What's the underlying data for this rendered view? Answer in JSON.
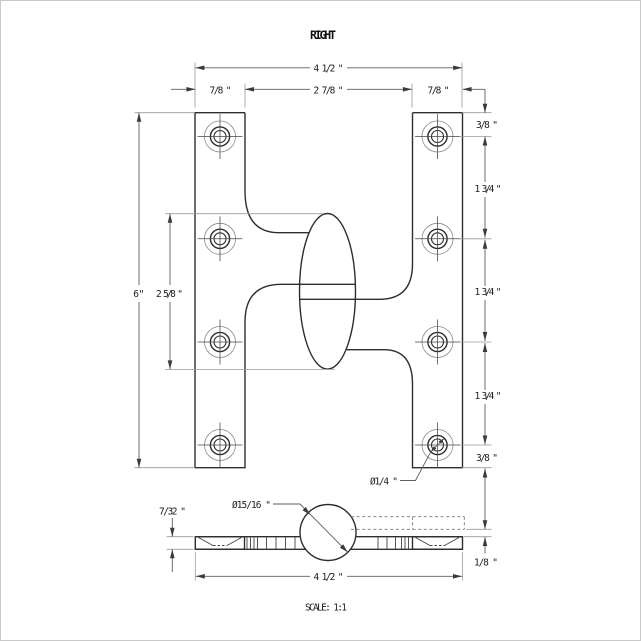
{
  "title": "RIGHT",
  "scale_label": "SCALE: 1:1",
  "front_view": {
    "overall_width": "4 1/2 \"",
    "left_leaf_width": "7/8 \"",
    "center_span": "2 7/8 \"",
    "right_leaf_width": "7/8 \"",
    "top_margin": "3/8 \"",
    "hole_pitch": [
      "1 3/4 \"",
      "1 3/4 \"",
      "1 3/4 \""
    ],
    "bottom_margin": "3/8 \"",
    "overall_height": "6\"",
    "knuckle_length": "2 5/8 \"",
    "screw_hole_diameter": "Ø1/4 \""
  },
  "bottom_view": {
    "knuckle_diameter": "Ø15/16 \"",
    "leaf_thickness": "7/32 \"",
    "leaf_offset": "1/8 \"",
    "overall_width": "4 1/2 \""
  },
  "colors": {
    "outline": "#2e2e2e",
    "dimension": "#5f5f5f",
    "extension": "#9b9b9b",
    "text": "#1c1c1c",
    "background": "#ffffff"
  }
}
